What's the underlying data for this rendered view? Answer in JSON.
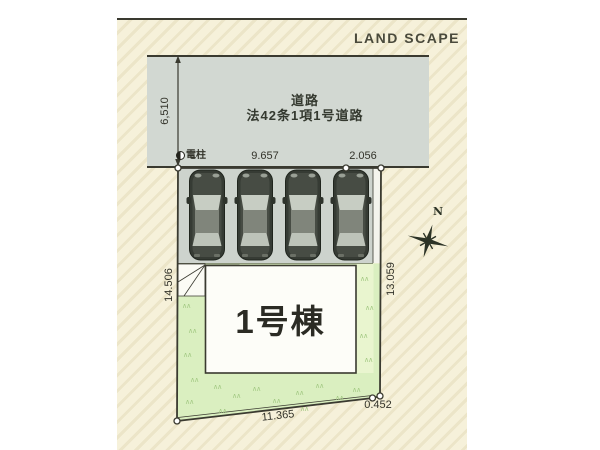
{
  "title": "LAND SCAPE",
  "road": {
    "name_line1": "道路",
    "name_line2": "法42条1項1号道路",
    "width_dim": "6,510"
  },
  "pole": {
    "label": "電柱"
  },
  "plot": {
    "building_label": "1号棟",
    "dims": {
      "top_left": "9.657",
      "top_right": "2.056",
      "left": "14.506",
      "right": "13.059",
      "bottom": "11.365",
      "bottom_right": "0.452"
    }
  },
  "compass": {
    "label": "N"
  },
  "colors": {
    "cream": "#f6f1da",
    "cream_stripe": "#ece5c8",
    "road_gray": "#d2d8d2",
    "parking_gray": "#cdd3cd",
    "lawn_green": "#daefc0",
    "lawn_light": "#e9f5cf",
    "line_dark": "#3a3a30",
    "text_dark": "#33332a",
    "car_body": "#363b34",
    "compass_dark": "#2c3326"
  }
}
